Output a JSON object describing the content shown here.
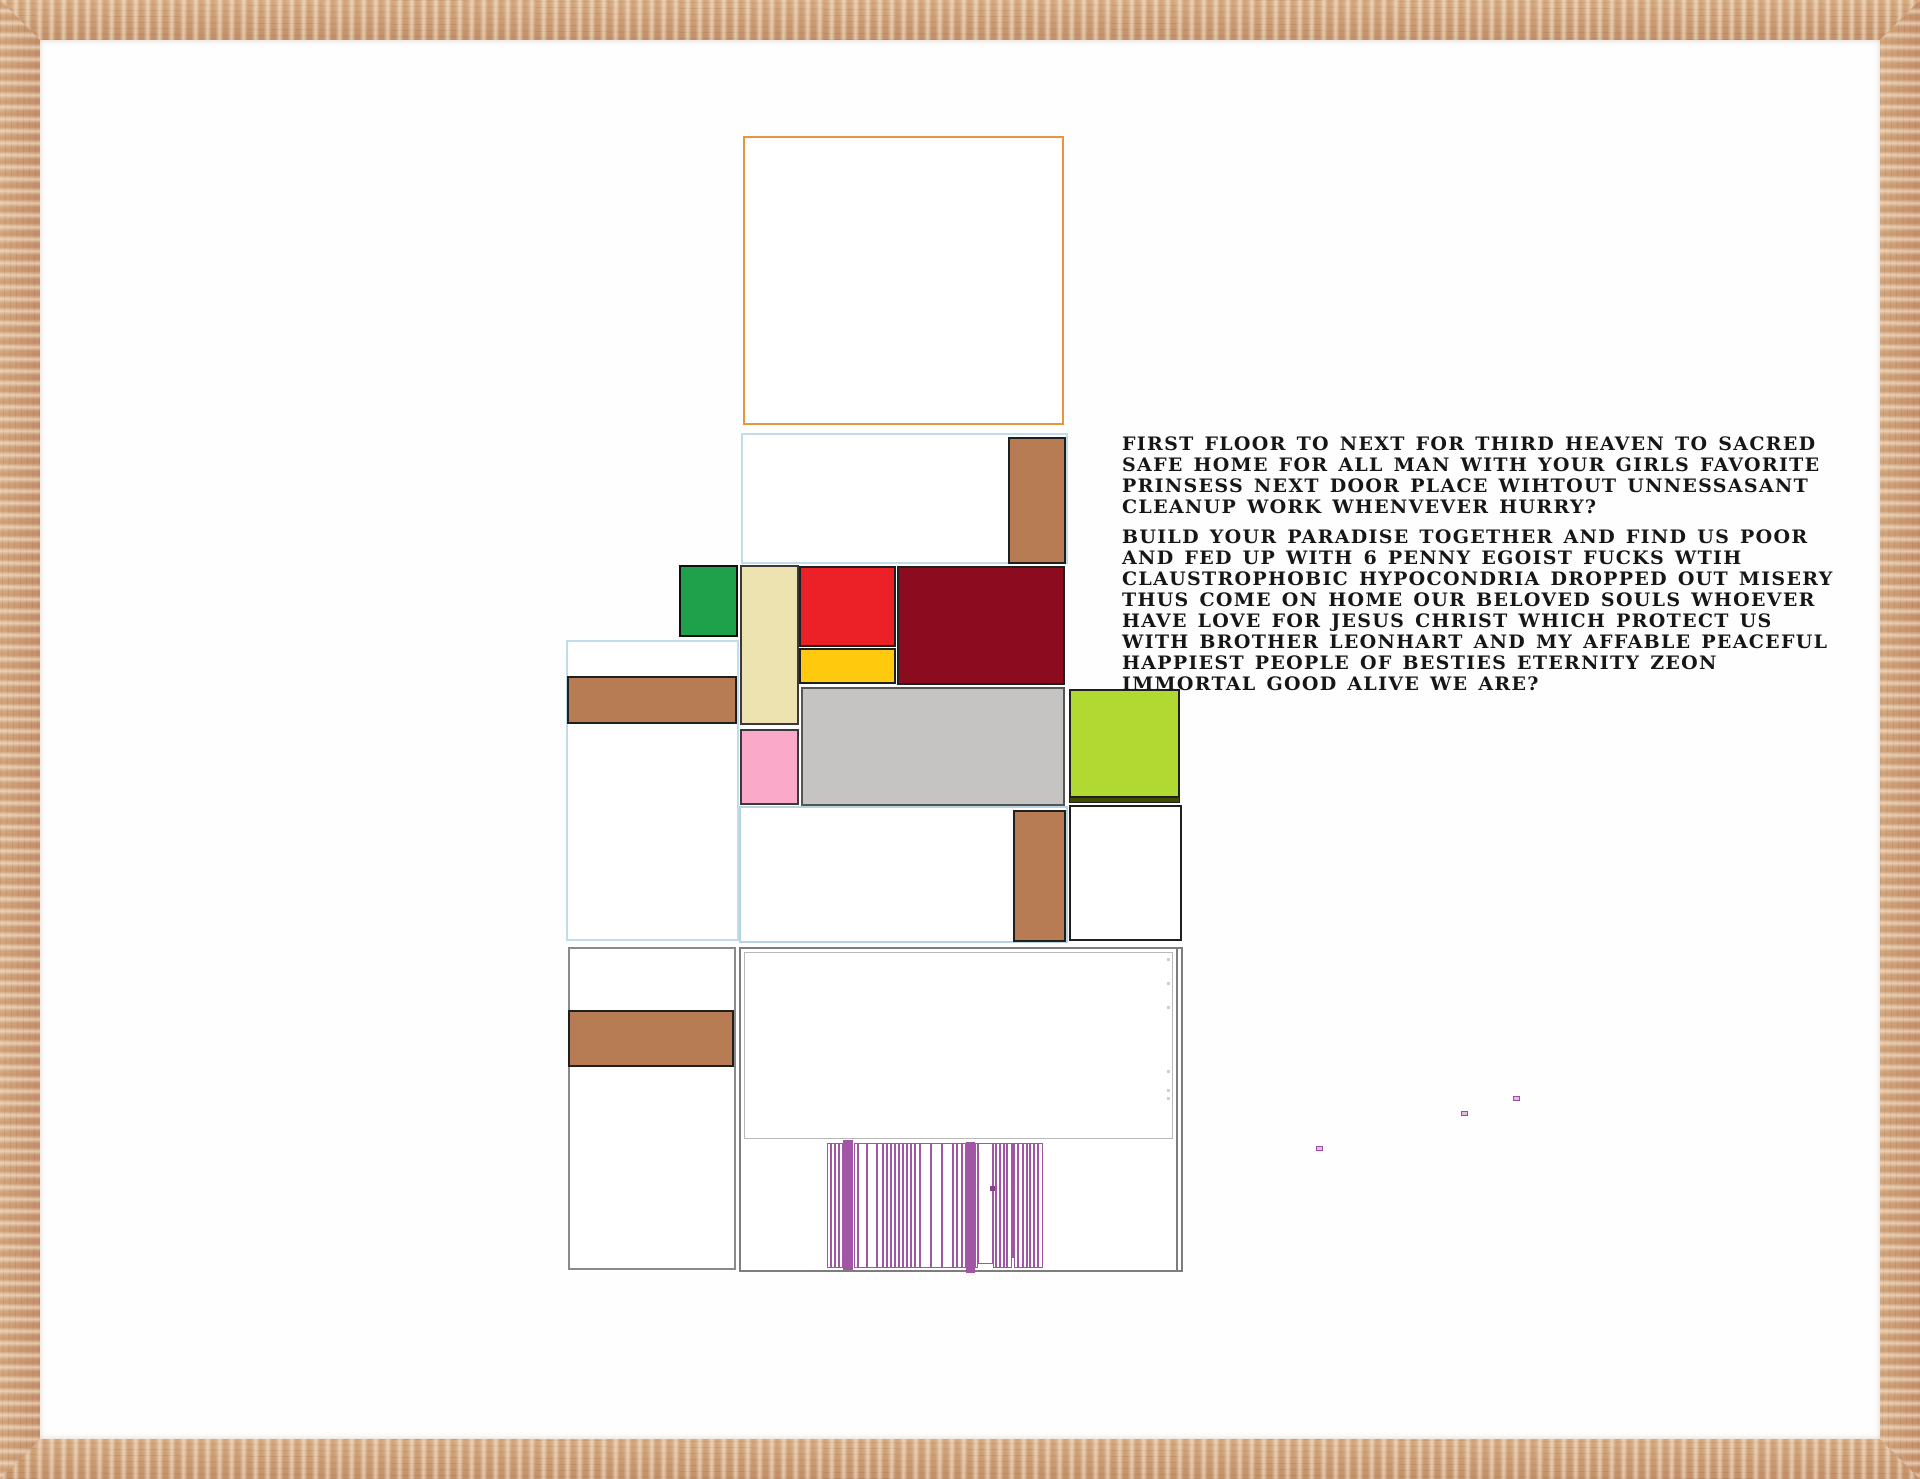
{
  "artwork": {
    "frame": {
      "material": "wood",
      "color": "#C89B73",
      "width_px": 40
    },
    "palette": {
      "orange_outline": "#E9953E",
      "light_blue_outline": "#BFDDEB",
      "brown": "#B87C55",
      "green": "#1FA04B",
      "cream": "#EDE3B1",
      "red": "#EC2127",
      "yellow": "#FFC90E",
      "maroon": "#8D0B1F",
      "pink": "#FBA9C9",
      "gray": "#C5C4C2",
      "chartreuse": "#B2D832",
      "dark_olive": "#3F4D00",
      "purple": "#A055A5",
      "text": "#161616"
    },
    "text_block": {
      "paragraphs": [
        {
          "lines": [
            "FIRST FLOOR TO NEXT FOR THIRD HEAVEN TO SACRED",
            "SAFE  HOME FOR ALL MAN WITH YOUR GIRLS FAVORITE",
            "PRINSESS NEXT DOOR PLACE WIHTOUT UNNESSASANT",
            "CLEANUP WORK WHENVEVER HURRY?"
          ]
        },
        {
          "lines": [
            "BUILD YOUR PARADISE TOGETHER AND FIND US POOR",
            "AND FED UP WITH 6 PENNY EGOIST FUCKS WTIH",
            "CLAUSTROPHOBIC HYPOCONDRIA DROPPED OUT MISERY",
            "THUS COME ON HOME OUR BELOVED SOULS WHOEVER",
            "HAVE LOVE FOR JESUS CHRIST WHICH PROTECT US",
            "WITH BROTHER LEONHART AND MY AFFABLE PEACEFUL",
            "HAPPIEST PEOPLE OF BESTIES ETERNITY ZEON",
            "IMMORTAL GOOD ALIVE WE ARE?"
          ]
        }
      ]
    },
    "blocks": [
      {
        "name": "orange-outline-rect",
        "x": 743,
        "y": 136,
        "w": 321,
        "h": 289,
        "fill": "#FFFFFF",
        "border": "#E9953E",
        "bw": 2
      },
      {
        "name": "blue-outline-rect-upper",
        "x": 741,
        "y": 433,
        "w": 327,
        "h": 131,
        "fill": "#FFFFFF",
        "border": "#BFDDEB",
        "bw": 2
      },
      {
        "name": "brown-block-upper-right",
        "x": 1008,
        "y": 437,
        "w": 58,
        "h": 127,
        "fill": "#B87C55",
        "border": "#1F1F1F",
        "bw": 2
      },
      {
        "name": "blue-outline-rect-left",
        "x": 566,
        "y": 640,
        "w": 173,
        "h": 301,
        "fill": "#FFFFFF",
        "border": "#BFDDEB",
        "bw": 2
      },
      {
        "name": "brown-bar-left",
        "x": 567,
        "y": 676,
        "w": 170,
        "h": 48,
        "fill": "#B87C55",
        "border": "#1F1F1F",
        "bw": 2
      },
      {
        "name": "mid-white-rect",
        "x": 739,
        "y": 806,
        "w": 329,
        "h": 137,
        "fill": "#FFFFFF",
        "border": "#B9D3E3",
        "bw": 2
      },
      {
        "name": "brown-block-mid",
        "x": 1013,
        "y": 810,
        "w": 53,
        "h": 132,
        "fill": "#B87C55",
        "border": "#1F1F1F",
        "bw": 2
      },
      {
        "name": "green-square",
        "x": 679,
        "y": 565,
        "w": 59,
        "h": 72,
        "fill": "#1FA04B",
        "border": "#101010",
        "bw": 2
      },
      {
        "name": "cream-vertical-rect",
        "x": 740,
        "y": 565,
        "w": 59,
        "h": 160,
        "fill": "#EDE3B1",
        "border": "#3A3A3A",
        "bw": 2
      },
      {
        "name": "red-rect",
        "x": 799,
        "y": 566,
        "w": 97,
        "h": 81,
        "fill": "#EC2127",
        "border": "#1F1F1F",
        "bw": 2
      },
      {
        "name": "yellow-rect",
        "x": 799,
        "y": 648,
        "w": 97,
        "h": 36,
        "fill": "#FFC90E",
        "border": "#1F1F1F",
        "bw": 2
      },
      {
        "name": "maroon-rect",
        "x": 897,
        "y": 566,
        "w": 168,
        "h": 119,
        "fill": "#8D0B1F",
        "border": "#1F1F1F",
        "bw": 2
      },
      {
        "name": "pink-rect",
        "x": 740,
        "y": 729,
        "w": 59,
        "h": 76,
        "fill": "#FBA9C9",
        "border": "#3A3A3A",
        "bw": 2
      },
      {
        "name": "gray-rect",
        "x": 801,
        "y": 687,
        "w": 264,
        "h": 119,
        "fill": "#C5C4C2",
        "border": "#555555",
        "bw": 2
      },
      {
        "name": "chartreuse-square",
        "x": 1069,
        "y": 689,
        "w": 111,
        "h": 109,
        "fill": "#B2D832",
        "border": "#1F1F1F",
        "bw": 2
      },
      {
        "name": "dark-olive-strip",
        "x": 1069,
        "y": 797,
        "w": 111,
        "h": 6,
        "fill": "#3F4D00",
        "border": "#1F1F1F",
        "bw": 1
      },
      {
        "name": "white-rect-right",
        "x": 1069,
        "y": 805,
        "w": 113,
        "h": 136,
        "fill": "#FFFFFF",
        "border": "#1F1F1F",
        "bw": 2
      },
      {
        "name": "bottom-left-rect",
        "x": 568,
        "y": 947,
        "w": 168,
        "h": 323,
        "fill": "#FFFFFF",
        "border": "#8A8A8A",
        "bw": 2
      },
      {
        "name": "brown-bar-bottom",
        "x": 568,
        "y": 1010,
        "w": 166,
        "h": 57,
        "fill": "#B87C55",
        "border": "#1F1F1F",
        "bw": 2
      },
      {
        "name": "bottom-big-rect",
        "x": 739,
        "y": 947,
        "w": 444,
        "h": 325,
        "fill": "#FFFFFF",
        "border": "#7D7D7D",
        "bw": 2
      },
      {
        "name": "bottom-big-rect-inner-edge",
        "x": 1176,
        "y": 949,
        "w": 2,
        "h": 321,
        "fill": "#7D7D7D",
        "border": "none",
        "bw": 0
      },
      {
        "name": "inner-outline-rect",
        "x": 744,
        "y": 952,
        "w": 429,
        "h": 187,
        "fill": "transparent",
        "border": "#B8B8B8",
        "bw": 1
      }
    ],
    "door": {
      "x": 827,
      "y": 1143,
      "w": 216,
      "h": 125,
      "line_color": "#A055A5",
      "strips": [
        {
          "x": 827,
          "w": 4
        },
        {
          "x": 831,
          "w": 4
        },
        {
          "x": 835,
          "w": 4
        },
        {
          "x": 839,
          "w": 4
        },
        {
          "x": 843,
          "w": 10,
          "filled": true,
          "y": 1140,
          "h": 130
        },
        {
          "x": 854,
          "w": 4
        },
        {
          "x": 858,
          "w": 9
        },
        {
          "x": 867,
          "w": 10
        },
        {
          "x": 877,
          "w": 6
        },
        {
          "x": 883,
          "w": 4
        },
        {
          "x": 887,
          "w": 4
        },
        {
          "x": 891,
          "w": 4
        },
        {
          "x": 895,
          "w": 4
        },
        {
          "x": 899,
          "w": 4
        },
        {
          "x": 903,
          "w": 4
        },
        {
          "x": 907,
          "w": 4
        },
        {
          "x": 911,
          "w": 4
        },
        {
          "x": 915,
          "w": 5
        },
        {
          "x": 920,
          "w": 11
        },
        {
          "x": 931,
          "w": 11
        },
        {
          "x": 942,
          "w": 11
        },
        {
          "x": 953,
          "w": 4
        },
        {
          "x": 957,
          "w": 5
        },
        {
          "x": 962,
          "w": 4
        },
        {
          "x": 966,
          "w": 9,
          "filled": true,
          "y": 1142,
          "h": 131
        },
        {
          "x": 975,
          "w": 3
        },
        {
          "x": 978,
          "w": 15,
          "h": 121
        },
        {
          "x": 993,
          "w": 3
        },
        {
          "x": 996,
          "w": 4
        },
        {
          "x": 1000,
          "w": 4
        },
        {
          "x": 1004,
          "w": 3
        },
        {
          "x": 1007,
          "w": 5
        },
        {
          "x": 1012,
          "w": 2,
          "h": 115
        },
        {
          "x": 1014,
          "w": 4
        },
        {
          "x": 1018,
          "w": 5
        },
        {
          "x": 1023,
          "w": 4
        },
        {
          "x": 1027,
          "w": 3
        },
        {
          "x": 1030,
          "w": 4
        },
        {
          "x": 1034,
          "w": 4
        },
        {
          "x": 1038,
          "w": 5
        }
      ],
      "knob": {
        "x": 990,
        "y": 1186,
        "w": 5,
        "h": 5,
        "color": "#8B3E8E"
      }
    },
    "purple_dots": [
      {
        "x": 1316,
        "y": 1146,
        "w": 7,
        "h": 5
      },
      {
        "x": 1461,
        "y": 1111,
        "w": 7,
        "h": 5
      },
      {
        "x": 1513,
        "y": 1096,
        "w": 7,
        "h": 5
      }
    ],
    "faint_specks": [
      {
        "x": 1167,
        "y": 958
      },
      {
        "x": 1167,
        "y": 982
      },
      {
        "x": 1167,
        "y": 1006
      },
      {
        "x": 1167,
        "y": 1070
      },
      {
        "x": 1167,
        "y": 1089
      },
      {
        "x": 1167,
        "y": 1097
      }
    ]
  }
}
